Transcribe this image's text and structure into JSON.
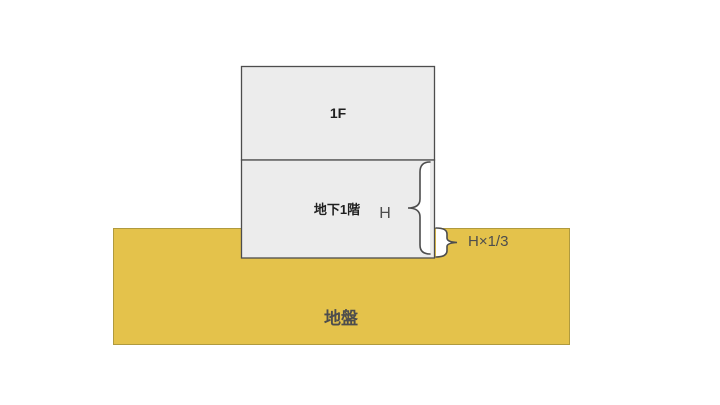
{
  "diagram": {
    "building": {
      "first_floor_label": "1F",
      "basement_label": "地下1階"
    },
    "annotations": {
      "basement_height_label": "H",
      "embedment_depth_label": "H×1/3"
    },
    "ground_label": "地盤",
    "colors": {
      "canvas_background": "#FFFFFF",
      "ground_fill": "#E4C24B",
      "ground_stroke": "#B09A3E",
      "building_fill": "#ECECEC",
      "building_stroke": "#4D4D4D",
      "brace_stroke": "#4D4D4D",
      "brace_fill": "#FFFFFF",
      "text_primary": "#1F1F1F",
      "text_secondary": "#4D4D4D"
    }
  }
}
